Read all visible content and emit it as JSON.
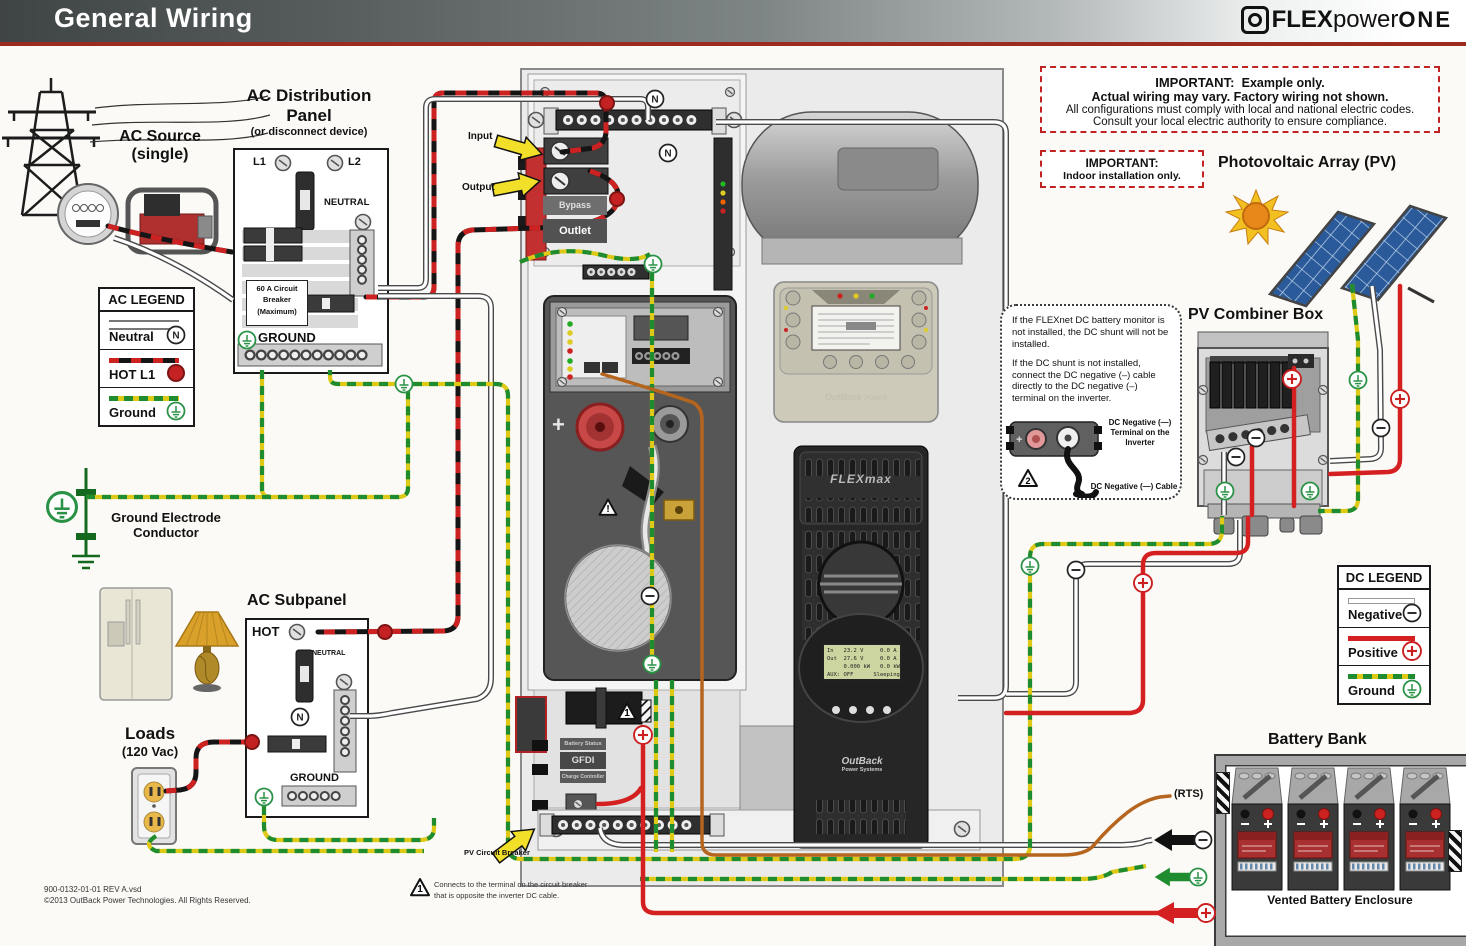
{
  "header": {
    "title": "General Wiring",
    "brand_flex": "FLEX",
    "brand_power": "power",
    "brand_one": "ONE"
  },
  "notices": {
    "main": {
      "title": "IMPORTANT:",
      "bold1": "Example only.",
      "bold2": "Actual wiring may vary.  Factory wiring not shown.",
      "line3": "All configurations must comply with local and national electric codes.",
      "line4": "Consult your local electric authority to ensure compliance."
    },
    "indoor": {
      "title": "IMPORTANT:",
      "text": "Indoor installation only."
    }
  },
  "ac_source": {
    "title": "AC Source",
    "subtitle": "(single)"
  },
  "ac_dist": {
    "title1": "AC Distribution",
    "title2": "Panel",
    "subtitle": "(or disconnect device)",
    "l1": "L1",
    "l2": "L2",
    "neutral": "NEUTRAL",
    "b1": "60 A Circuit",
    "b2": "Breaker",
    "b3": "(Maximum)",
    "ground": "GROUND"
  },
  "ac_legend": {
    "title": "AC LEGEND",
    "neutral": "Neutral",
    "hot": "HOT L1",
    "ground": "Ground"
  },
  "ground_electrode": {
    "line1": "Ground Electrode",
    "line2": "Conductor"
  },
  "loads": {
    "title": "Loads",
    "subtitle": "(120 Vac)"
  },
  "ac_subpanel": {
    "title": "AC Subpanel",
    "hot": "HOT",
    "neutral": "NEUTRAL",
    "ground": "GROUND"
  },
  "center": {
    "input": "Input",
    "output": "Output",
    "bypass": "Bypass",
    "outlet": "Outlet",
    "battery_status": "Battery Status",
    "gfdi": "GFDI",
    "charge_controller": "Charge Controller",
    "pv_breaker": "PV Circuit Breaker",
    "flexmax": "FLEXmax",
    "outback1": "OutBack",
    "outback2": "Power Systems",
    "mate_logo1": "OutBack",
    "mate_logo2": "POWER",
    "lcd": [
      "In   23.2 V     0.0 A",
      "Out  27.6 V     0.0 A",
      "     0.000 kW   0.0 kWH",
      "AUX: OFF      Sleeping"
    ]
  },
  "pv": {
    "array_title": "Photovoltaic Array (PV)",
    "combiner_title": "PV Combiner Box"
  },
  "flexnet_note": {
    "p1": "If the FLEXnet DC battery monitor is not installed, the DC shunt will not be installed.",
    "p2": "If the DC shunt is not installed, connect the DC negative (–) cable directly to the DC negative (–) terminal on the inverter.",
    "lbl1a": "DC Negative (—)",
    "lbl1b": "Terminal on the",
    "lbl1c": "Inverter",
    "lbl2": "DC Negative (—) Cable"
  },
  "dc_legend": {
    "title": "DC LEGEND",
    "negative": "Negative",
    "positive": "Positive",
    "ground": "Ground"
  },
  "battery": {
    "title": "Battery Bank",
    "enclosure": "Vented Battery Enclosure",
    "rts": "(RTS)"
  },
  "footer": {
    "line1": "900-0132-01-01 REV A.vsd",
    "line2": "©2013 OutBack Power Technologies.  All Rights Reserved."
  },
  "note1": {
    "line1": "Connects to the terminal on the circuit breaker",
    "line2": "that is opposite the inverter DC cable."
  },
  "colors": {
    "accent_red": "#9c2b1f",
    "hot": "#cc2222",
    "ground_green": "#1f8c2f",
    "ground_yellow": "#ddc916",
    "dc_positive": "#d42020"
  }
}
